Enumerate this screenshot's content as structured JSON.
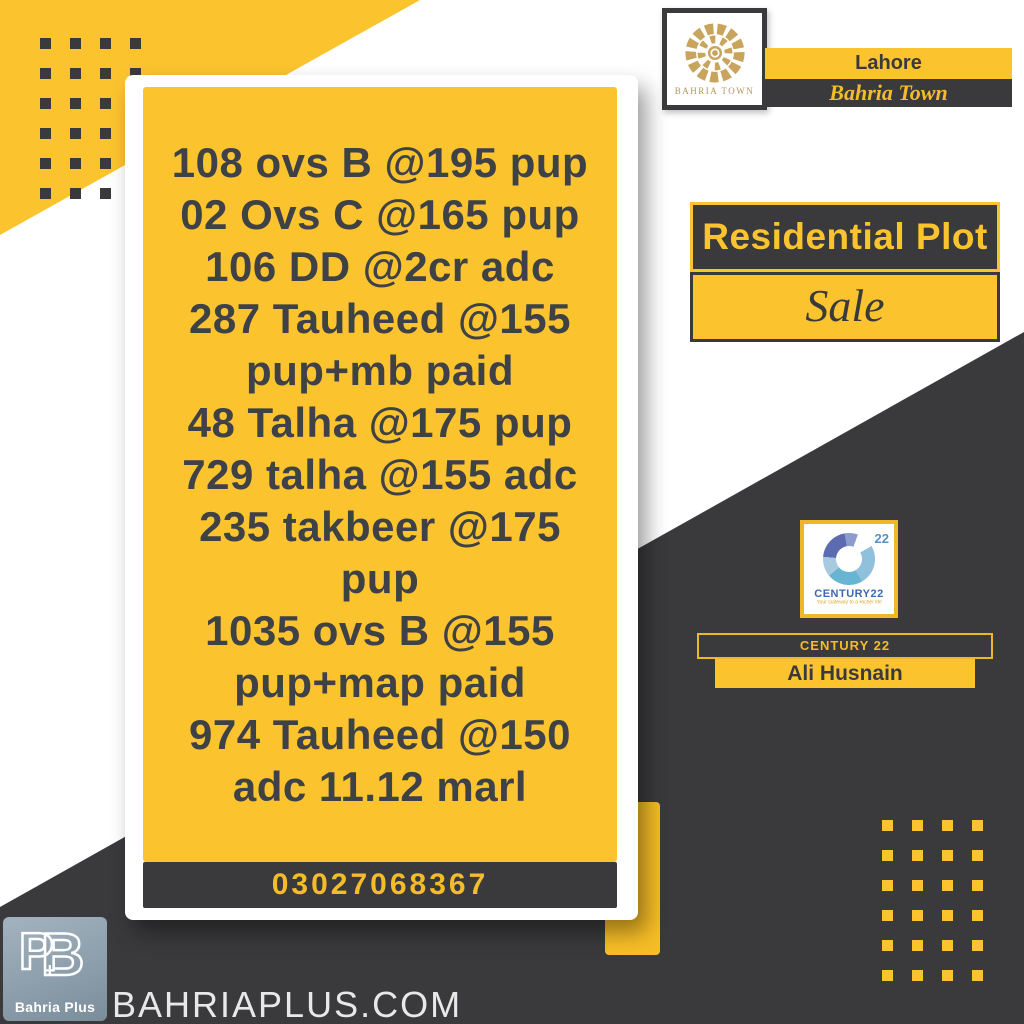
{
  "colors": {
    "yellow": "#FBC42F",
    "charcoal": "#3A3A3C",
    "gold": "#C8A45C",
    "phone_text": "#F5BC2A",
    "century_blue": "#3E68AE",
    "listing_text": "#3E4146"
  },
  "card": {
    "lines": [
      "108 ovs B @195 pup",
      "02 Ovs C @165 pup",
      "106 DD @2cr adc",
      "287 Tauheed @155",
      "pup+mb paid",
      "48 Talha @175 pup",
      "729 talha @155 adc",
      "235 takbeer @175",
      "pup",
      "1035 ovs B @155",
      "pup+map paid",
      "974 Tauheed @150",
      "adc 11.12 marl"
    ],
    "phone": "03027068367"
  },
  "brand": {
    "emblem_label": "BAHRIA TOWN",
    "city": "Lahore",
    "community": "Bahria Town"
  },
  "offer": {
    "type": "Residential Plot",
    "status": "Sale"
  },
  "agent": {
    "agency": "CENTURY 22",
    "name": "Ali Husnain",
    "logo_text": "CENTURY22",
    "logo_number": "22",
    "tagline": "Your Gateway to a Richer life"
  },
  "footer": {
    "company": "Bahria Plus",
    "website": "BAHRIAPLUS.COM"
  }
}
